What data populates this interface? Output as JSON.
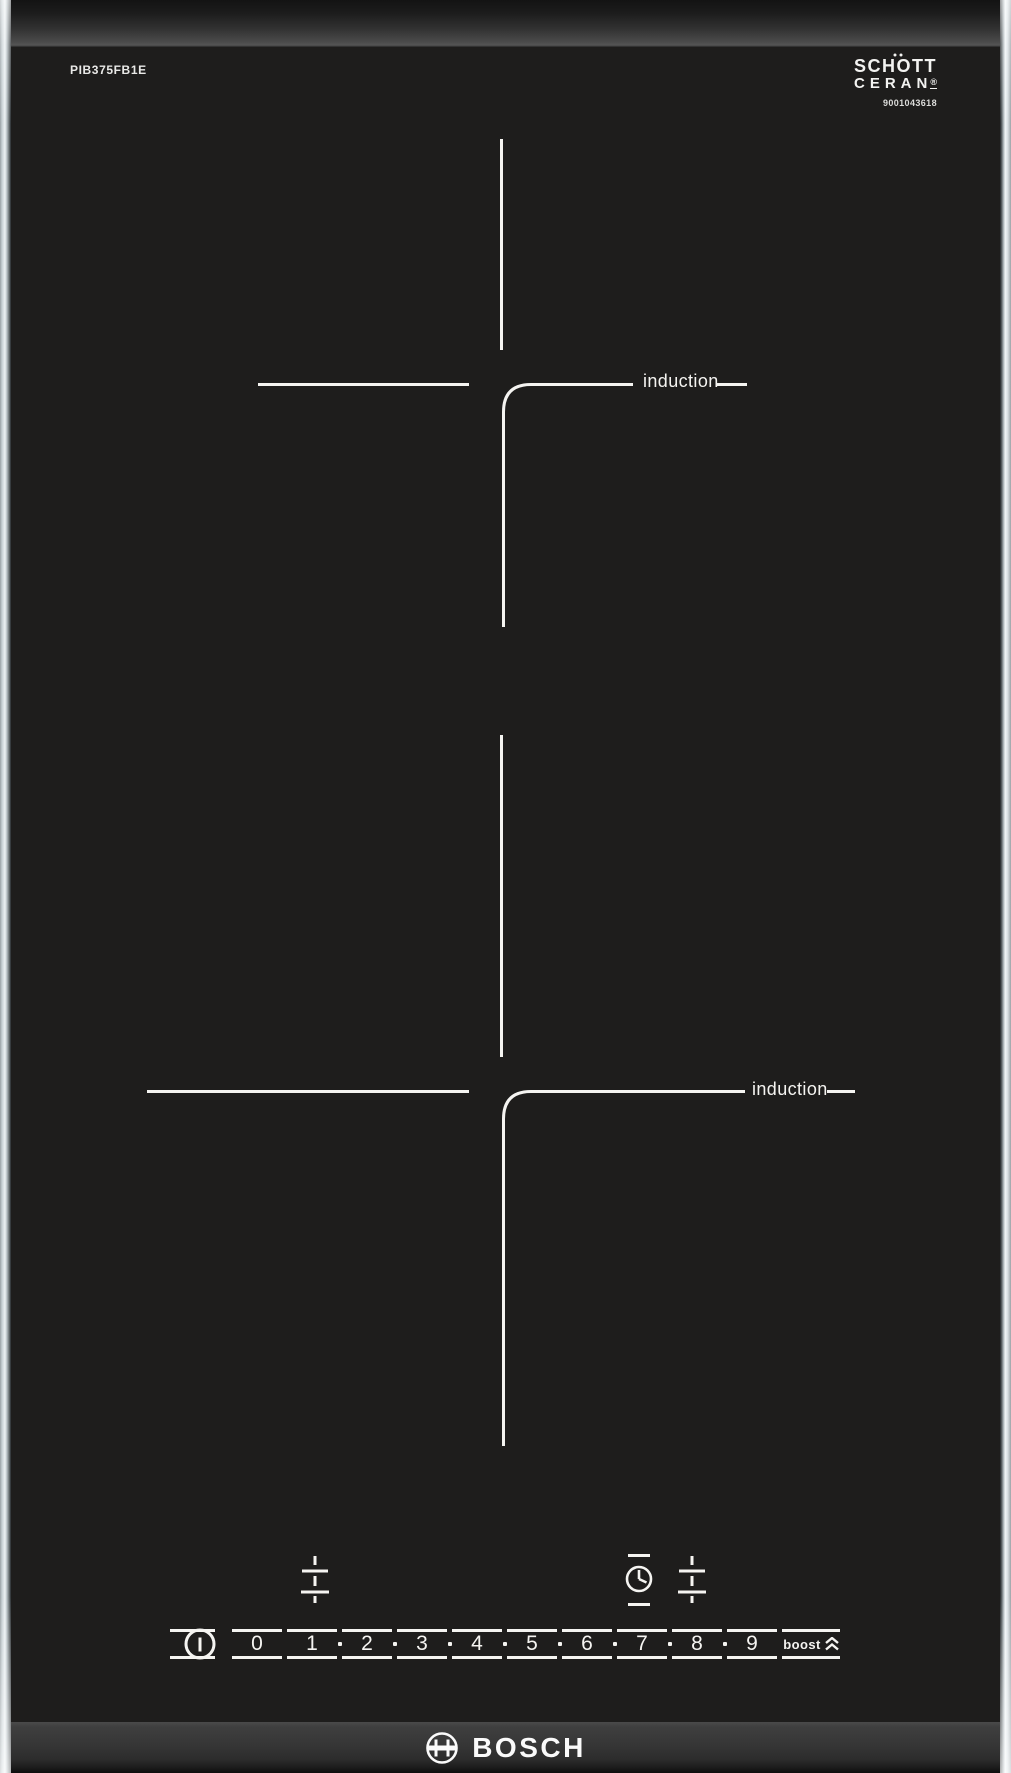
{
  "product": {
    "model_number": "PIB375FB1E",
    "serial_number": "9001043618",
    "brand": "BOSCH",
    "glass_brand_line1": "SCHOTT",
    "glass_brand_line2": "CERAN",
    "registered_mark": "®"
  },
  "zones": [
    {
      "position": "rear",
      "label": "induction"
    },
    {
      "position": "front",
      "label": "induction"
    }
  ],
  "control_panel": {
    "power_icon": "power-icon",
    "levels": [
      "0",
      "1",
      "2",
      "3",
      "4",
      "5",
      "6",
      "7",
      "8",
      "9"
    ],
    "boost_label": "boost",
    "boost_icon": "double-chevron-up-icon",
    "timer_icon": "timer-clock-icon",
    "front_zone_icon": "level-adjust-icon",
    "rear_zone_icon": "level-adjust-icon"
  },
  "colors": {
    "glass": "#1e1d1c",
    "line": "#f5f4f1",
    "trim_bright": "#eef2f4",
    "bevel_top_light": "#4c4c4c",
    "bevel_bottom_light": "#3f3f3f"
  }
}
